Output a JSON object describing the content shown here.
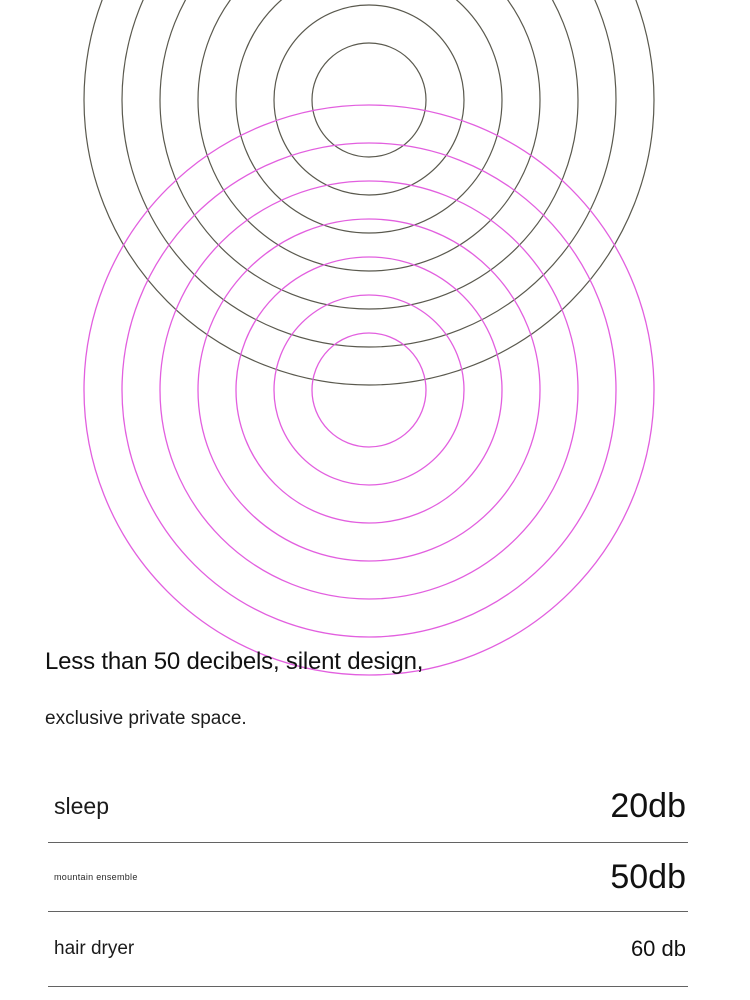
{
  "graphic": {
    "description": "two overlapping sets of concentric sound-ripple circles",
    "ripple_sets": [
      {
        "name": "dark-ripples",
        "cx": 369,
        "cy": 100,
        "color": "#5a594e",
        "stroke_width": 1.2,
        "radii": [
          57,
          95,
          133,
          171,
          209,
          247,
          285
        ]
      },
      {
        "name": "magenta-ripples",
        "cx": 369,
        "cy": 390,
        "color": "#e25fdf",
        "stroke_width": 1.3,
        "radii": [
          57,
          95,
          133,
          171,
          209,
          247,
          285
        ]
      }
    ]
  },
  "headline": {
    "line1": "Less than 50 decibels, silent design,",
    "line2": "exclusive private space."
  },
  "noise_table": {
    "rows": [
      {
        "label": "sleep",
        "value": "20db"
      },
      {
        "label": "mountain ensemble",
        "value": "50db"
      },
      {
        "label": "hair dryer",
        "value": "60 db"
      }
    ]
  },
  "colors": {
    "background": "#ffffff",
    "text": "#111111",
    "divider": "#636363",
    "dark_ripple": "#5a594e",
    "magenta_ripple": "#e25fdf"
  }
}
